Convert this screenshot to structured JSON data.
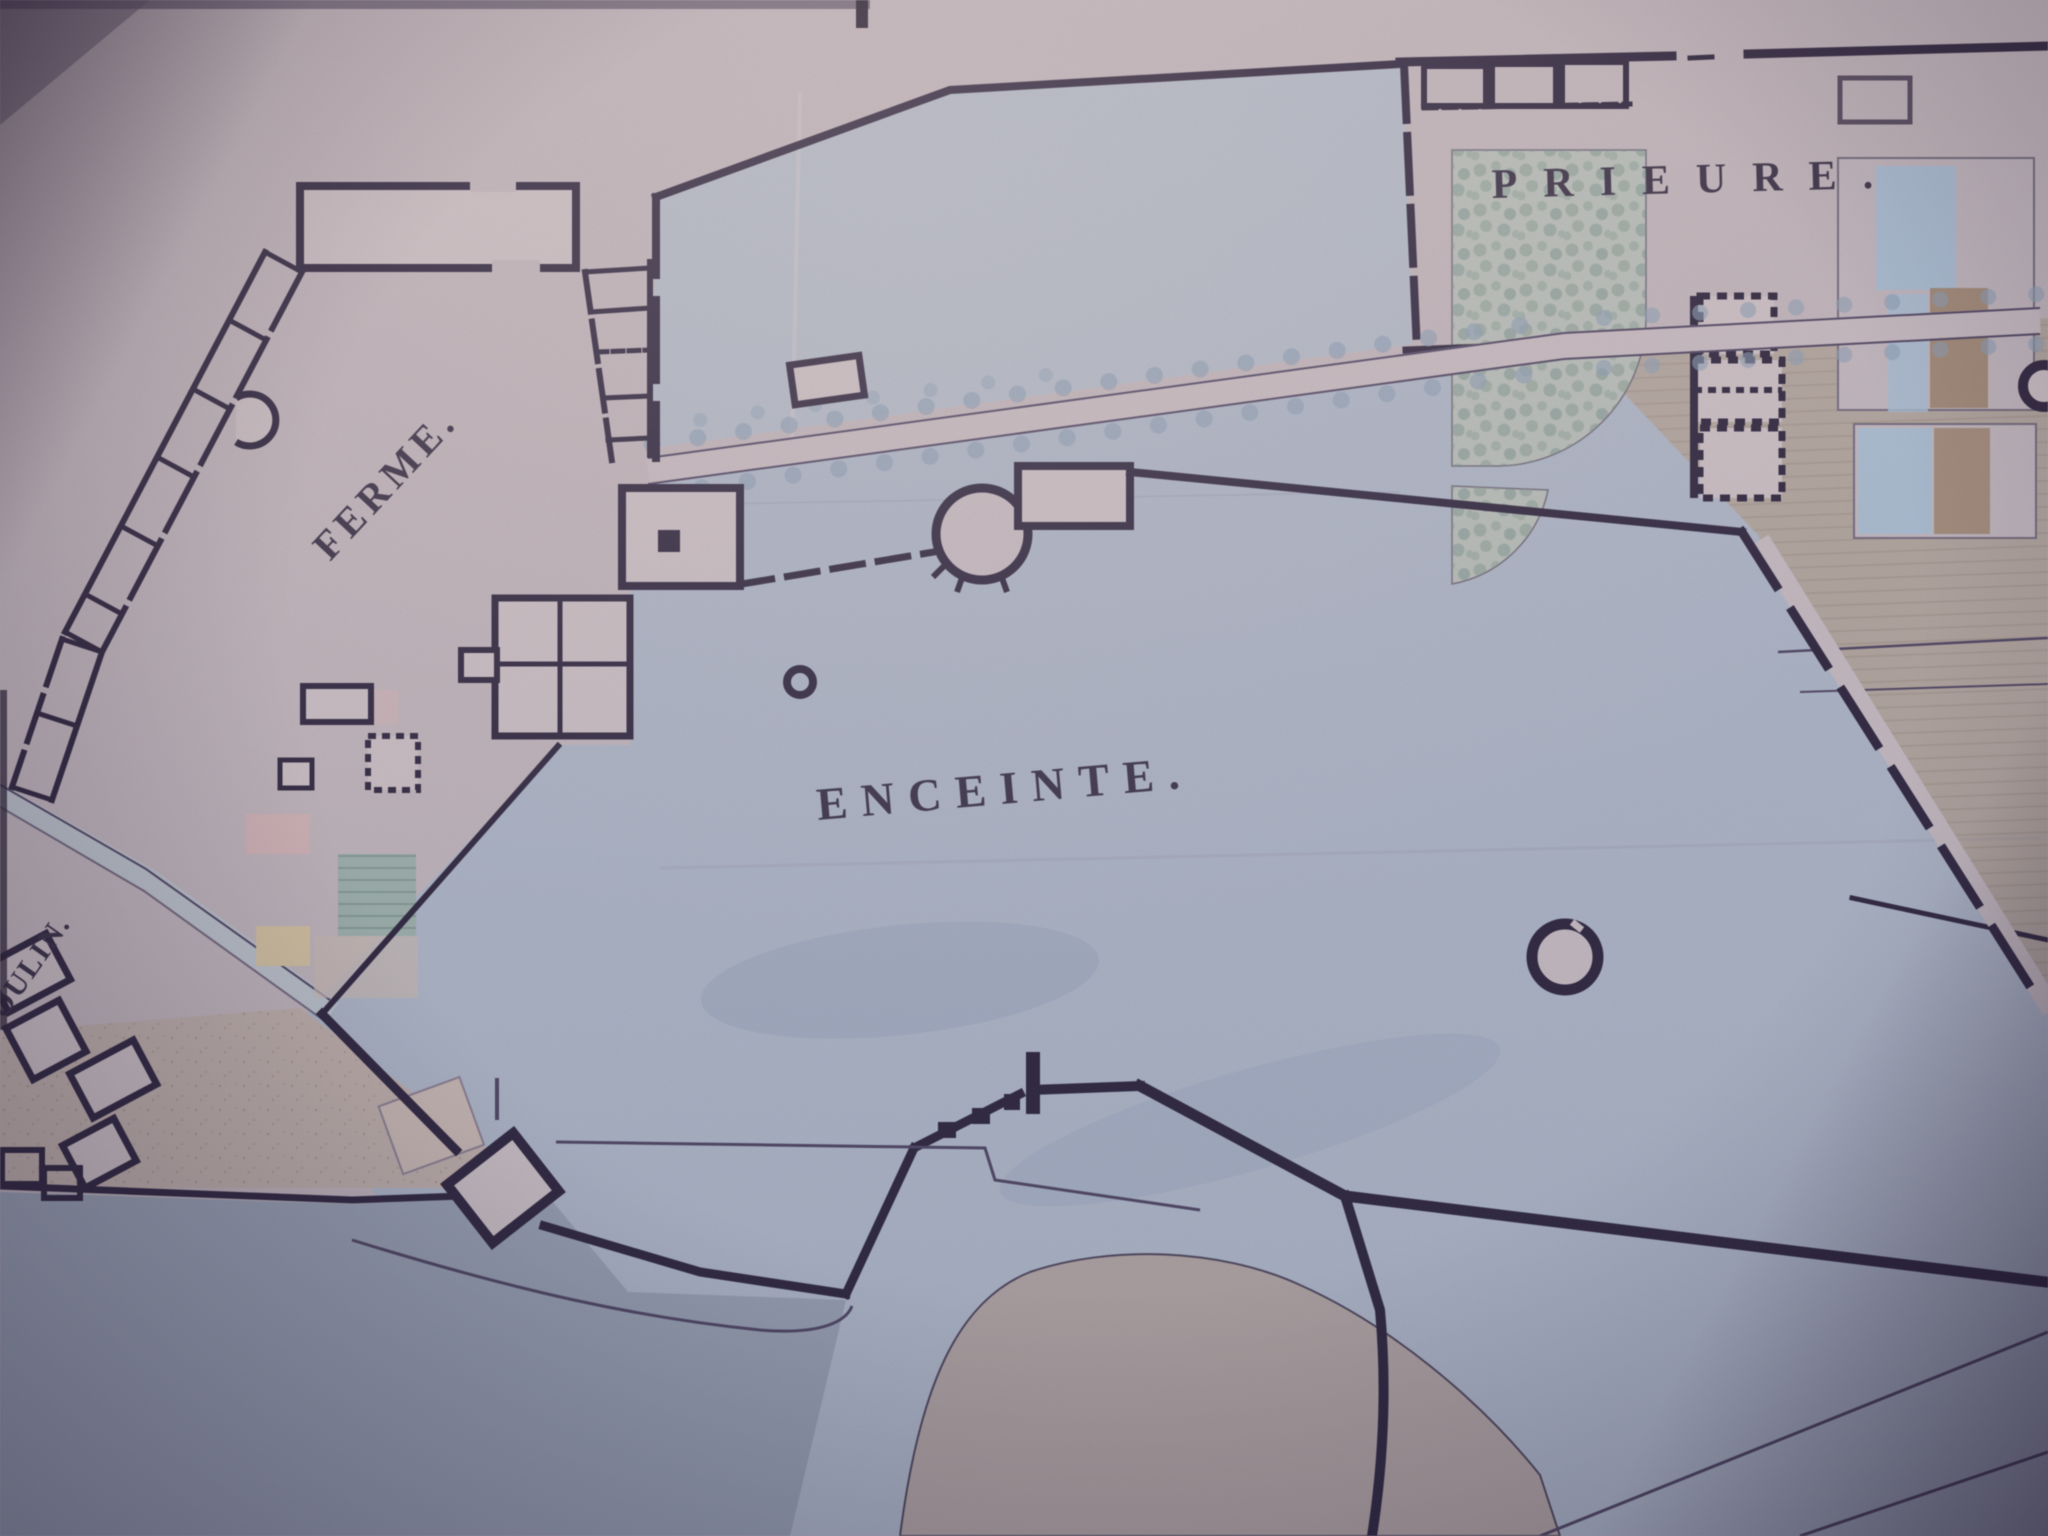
{
  "map": {
    "labels": {
      "ferme": "FERME.",
      "enceinte": "ENCEINTE.",
      "prieure": "PRIEURE.",
      "moulin": "OULIN."
    },
    "colors": {
      "paper": "#c2b8bd",
      "paper_light": "#cdc3c6",
      "ink": "#29223a",
      "thin_line": "#4b4360",
      "wash_blue_upper": "#b3bdca",
      "wash_blue_enceinte": "#aeb9c9",
      "wash_pond": "#97a2b2",
      "field_tan_east": "#b3a89f",
      "field_tan_southwest": "#c0b2ab",
      "mound_tan": "#b2a5a1",
      "garden_stipple_green": "#7f988c",
      "flowerbed_blue": "#a7c2d8",
      "flowerbed_brown": "#9c8368",
      "plot_pink": "#d6b6b6",
      "plot_teal": "#9db3ac",
      "plot_yellow": "#d5c5a1",
      "tree_dot_blue": "#8aa0b6",
      "label_ink": "#342d42"
    },
    "features": {
      "ferme": "farm building range (top left)",
      "enceinte": "walled enclosure with blue wash (center)",
      "prieure": "priory formal gardens (top right)",
      "moulin": "mill buildings at left edge",
      "tree_avenue": "double row of trees along a road",
      "pond": "pond at bottom left",
      "well": "small well ring in enceinte",
      "tower": "large round tower ring",
      "ramparts": "thick stepped rampart wall with bastion"
    }
  }
}
